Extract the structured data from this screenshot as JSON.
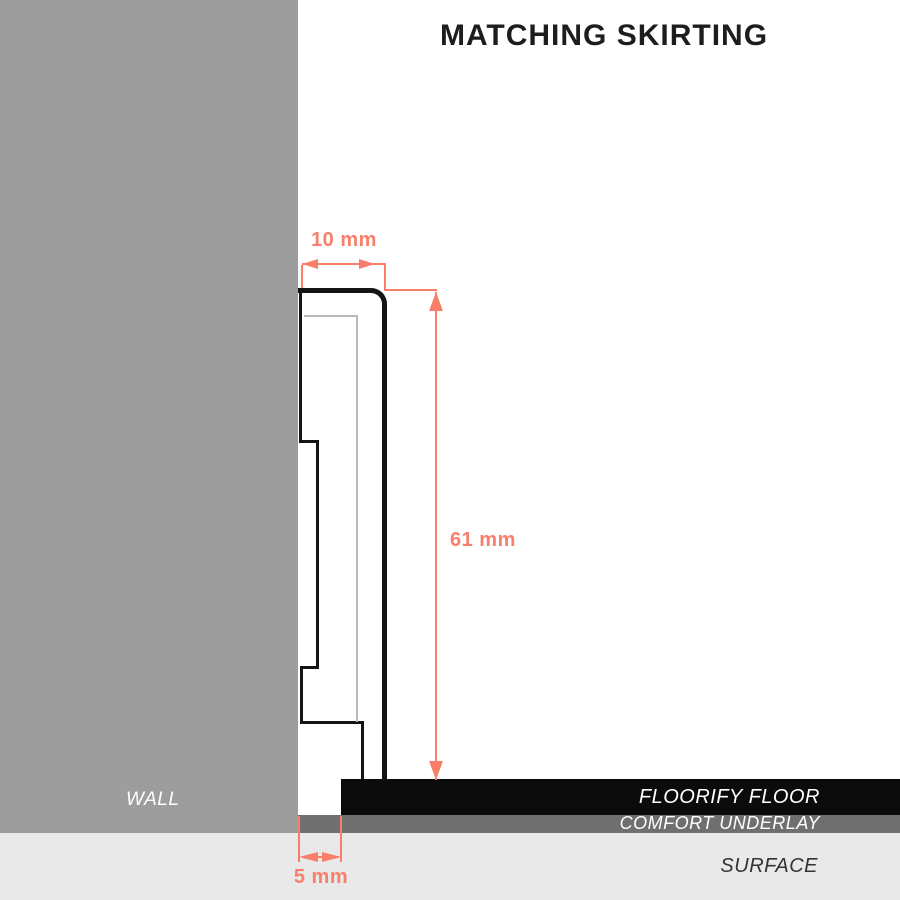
{
  "title": "MATCHING SKIRTING",
  "labels": {
    "wall": "WALL",
    "floor": "FLOORIFY FLOOR",
    "underlay": "COMFORT UNDERLAY",
    "surface": "SURFACE"
  },
  "dimensions": {
    "skirting_width": "10 mm",
    "skirting_height": "61 mm",
    "expansion_gap": "5 mm"
  },
  "colors": {
    "accent": "#F8806B",
    "wall": "#9D9D9D",
    "underlay": "#6F6F6F",
    "floor": "#0B0B0B",
    "surface": "#E9E9E9",
    "outline": "#141414",
    "inner": "#B9B9B9",
    "title-color": "#1D1D1D",
    "label-light": "#FFFFFF",
    "surface-label": "#333333"
  }
}
